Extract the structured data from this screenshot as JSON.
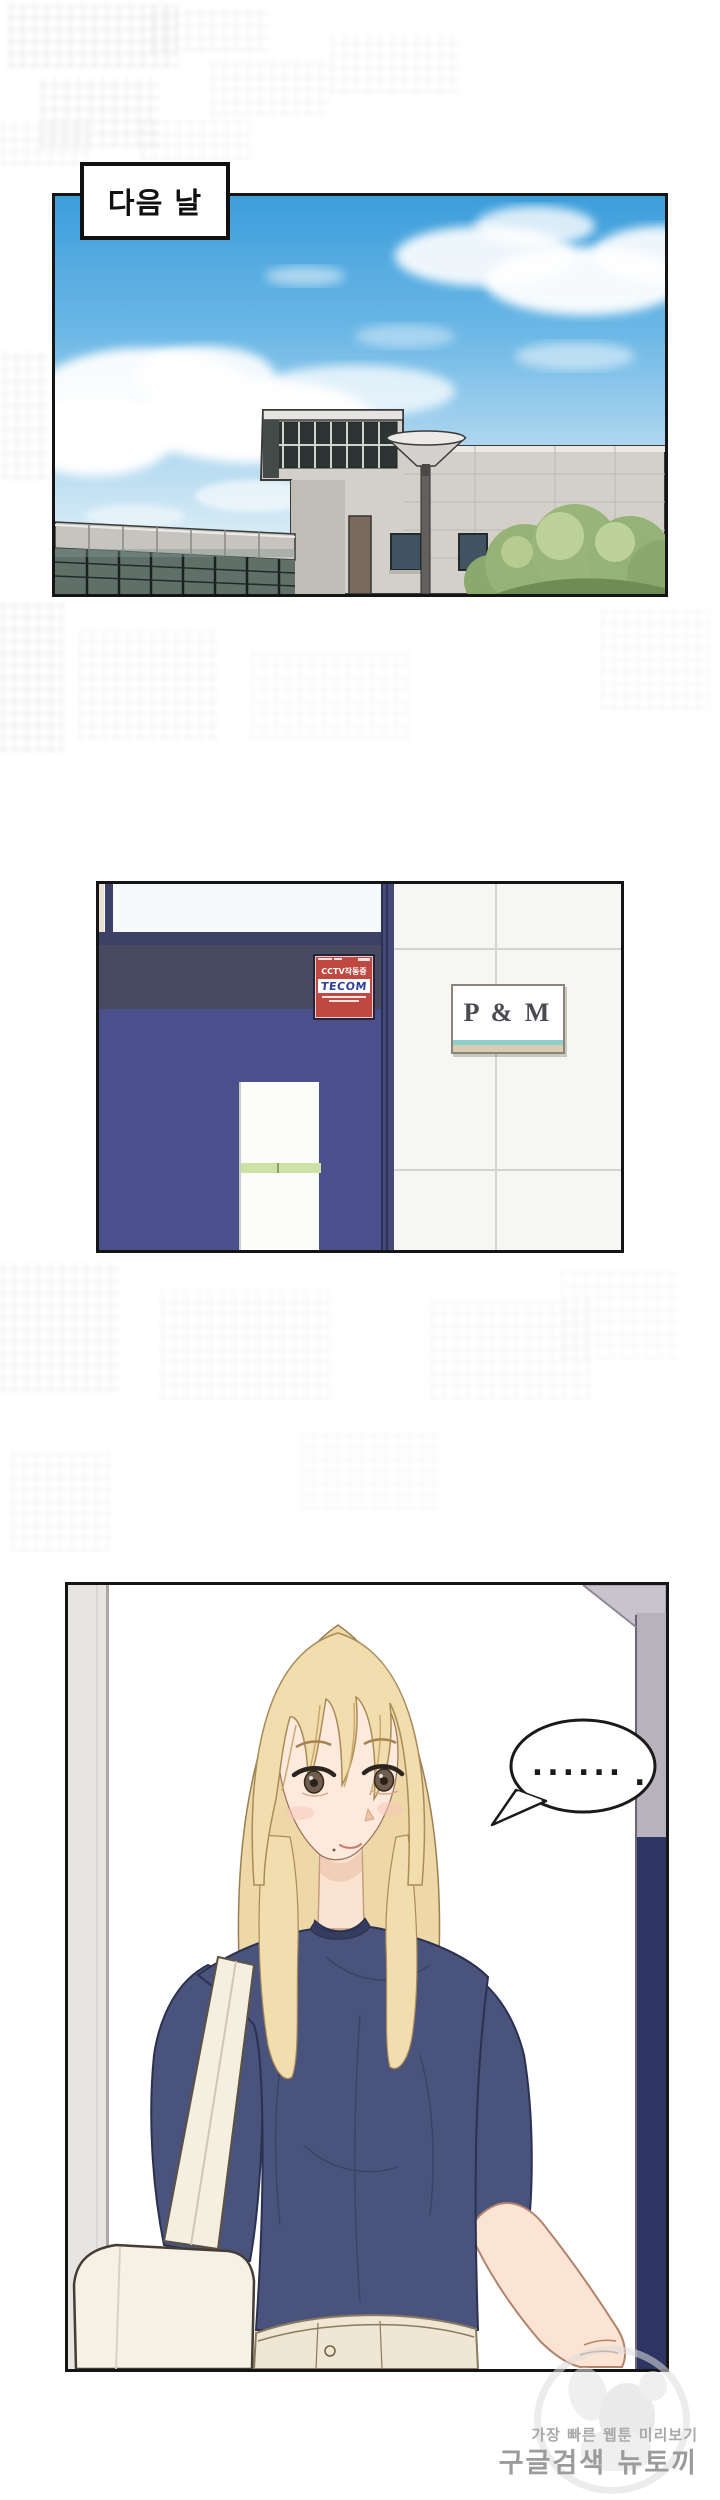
{
  "page": {
    "width": 720,
    "height": 2500
  },
  "panel1": {
    "caption": "다음 날"
  },
  "panel2": {
    "sticker": {
      "cctv_text": "CCTV작동중",
      "brand": "TECOM"
    },
    "sign_text": "P & M"
  },
  "panel3": {
    "bubble_dots": "......",
    "bubble_extra_dot": "."
  },
  "watermark": {
    "tagline": "가장 빠른 웹툰 미리보기",
    "brand": "구글검색 뉴토끼"
  },
  "colors": {
    "sky_blue": "#3d9edb",
    "door_blue": "#4b508d",
    "sticker_red": "#bf4840",
    "tecom_blue": "#2f3f96",
    "sign_text_gray": "#4a4a52",
    "sign_accent_teal": "#8ed0c9",
    "shirt_navy": "#4a537c",
    "hair_blonde": "#f2ddae",
    "skirt_beige": "#efe7d4",
    "bag_cream": "#f6f1e5"
  }
}
